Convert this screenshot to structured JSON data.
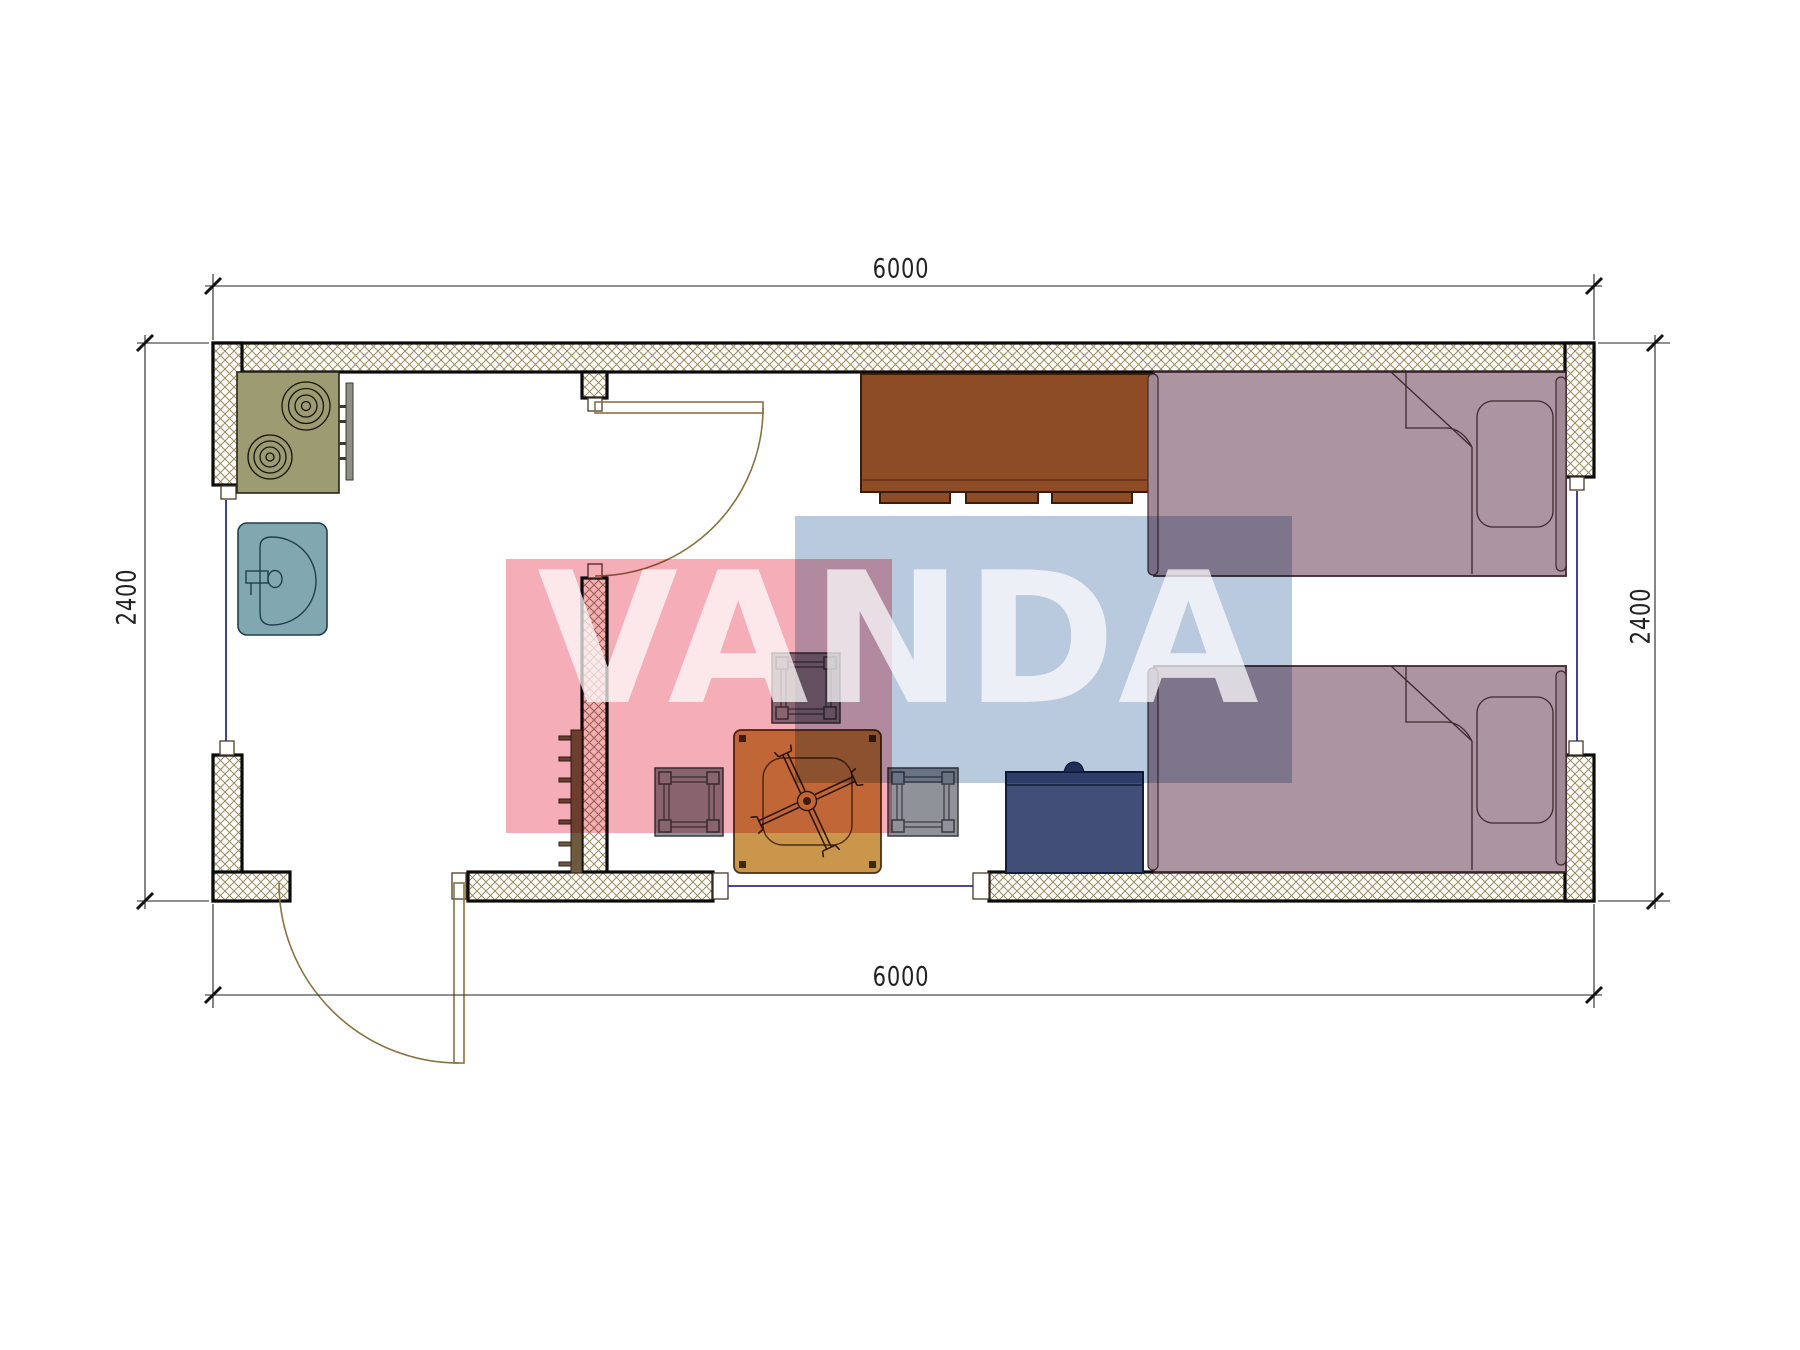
{
  "watermark": {
    "text": "VANDA",
    "pink": "#f5aeb8",
    "blue": "#b9cade"
  },
  "dimensions": {
    "top": "6000",
    "bottom": "6000",
    "left": "2400",
    "right": "2400",
    "unit": "mm"
  },
  "plan": {
    "type": "floor-plan",
    "rooms": [
      "kitchen-entry-room",
      "living-sleeping-room"
    ],
    "furniture": [
      "stove-two-burners",
      "sink",
      "wardrobe-cabinet",
      "single-bed-top",
      "single-bed-bottom",
      "pillow-top-bed",
      "pillow-bottom-bed",
      "nightstand-chest",
      "square-table-with-cross-base",
      "stool-top",
      "stool-left",
      "stool-right",
      "radiator"
    ],
    "openings": [
      "interior-door",
      "entrance-door",
      "window-left",
      "window-right",
      "window-bottom"
    ]
  },
  "colors": {
    "wall-hatch": "#9b8c5c",
    "wall-line": "#0b0b0b",
    "stove": "#9c9b72",
    "stove-line": "#26261a",
    "sink": "#81a8b1",
    "sink-line": "#223f49",
    "cabinet": "#8d4b26",
    "cabinet-line": "#3a1d0e",
    "bed": "#ac94a0",
    "bed-line": "#42272f",
    "bed-bar": "#a18a96",
    "nightstand": "#404e78",
    "nightstand-line": "#141d3a",
    "stool": "#8f9298",
    "stool-line": "#3a3a40",
    "table": "#c9964b",
    "table-line": "#4c3115",
    "radiator": "#6f5a40",
    "door": "#8a7140",
    "window": "#2b2f8a",
    "dim": "#222222",
    "wm-pink": "#f5aeb8",
    "wm-blue": "#b9cade"
  }
}
